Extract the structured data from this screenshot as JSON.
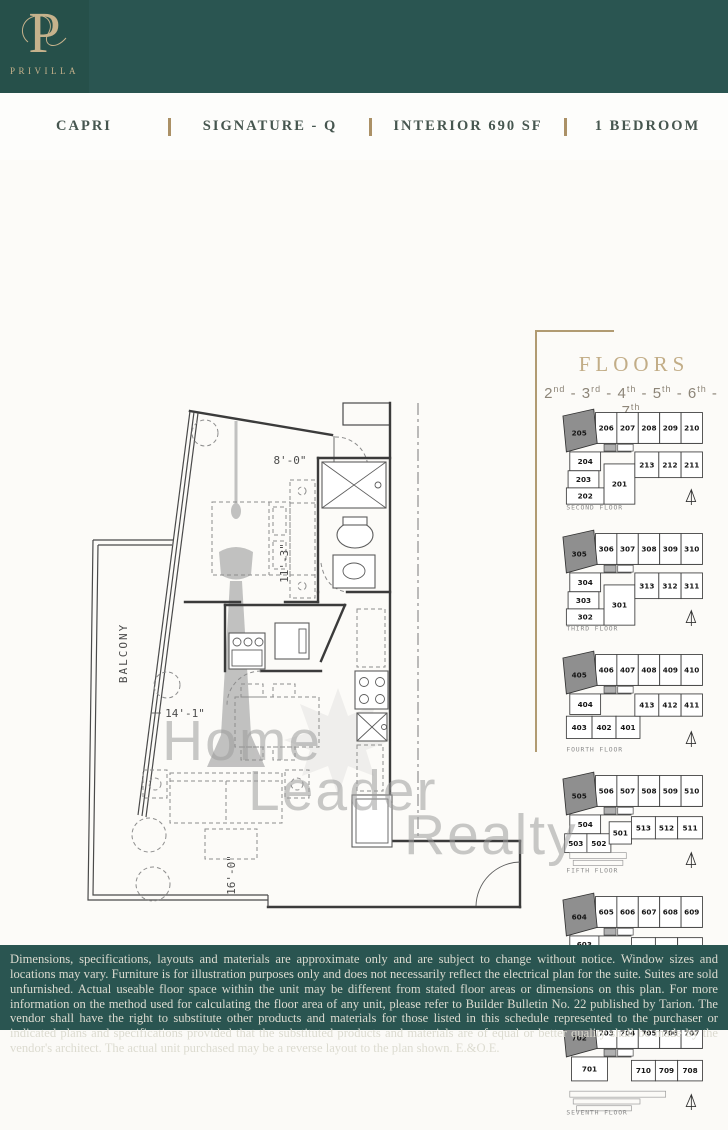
{
  "brand": {
    "monogram": "P",
    "name": "PRIVILLA"
  },
  "title_bar": {
    "items": [
      "CAPRI",
      "SIGNATURE - Q",
      "INTERIOR 690 SF",
      "1 BEDROOM"
    ]
  },
  "plan": {
    "labels": {
      "balcony": "BALCONY"
    },
    "dimensions": {
      "entry": "8'-0\"",
      "bedroom": "11'-3\"",
      "living_width": "14'-1\"",
      "living_depth": "16'-0\""
    },
    "watermark": {
      "line1": "Home",
      "line2": "Leader",
      "line3": "Realty"
    }
  },
  "floors_panel": {
    "title": "FLOORS",
    "range": [
      [
        "2",
        "nd"
      ],
      [
        "3",
        "rd"
      ],
      [
        "4",
        "th"
      ],
      [
        "5",
        "th"
      ],
      [
        "6",
        "th"
      ],
      [
        "7",
        "th"
      ]
    ],
    "range_separator": " - ",
    "floors": [
      {
        "name": "SECOND FLOOR",
        "layout": "A",
        "highlight": "205",
        "top": [
          "206",
          "207",
          "208",
          "209",
          "210"
        ],
        "units": [
          "204",
          "203",
          "202",
          "201",
          "213",
          "212",
          "211"
        ]
      },
      {
        "name": "THIRD FLOOR",
        "layout": "A",
        "highlight": "305",
        "top": [
          "306",
          "307",
          "308",
          "309",
          "310"
        ],
        "units": [
          "304",
          "303",
          "302",
          "301",
          "313",
          "312",
          "311"
        ]
      },
      {
        "name": "FOURTH FLOOR",
        "layout": "B",
        "highlight": "405",
        "top": [
          "406",
          "407",
          "408",
          "409",
          "410"
        ],
        "units": [
          "404",
          "403",
          "402",
          "401",
          "413",
          "412",
          "411"
        ]
      },
      {
        "name": "FIFTH FLOOR",
        "layout": "C",
        "highlight": "505",
        "top": [
          "506",
          "507",
          "508",
          "509",
          "510"
        ],
        "units": [
          "504",
          "503",
          "502",
          "501",
          "513",
          "512",
          "511"
        ]
      },
      {
        "name": "SIXTH FLOOR",
        "layout": "D",
        "highlight": "604",
        "top": [
          "605",
          "606",
          "607",
          "608",
          "609"
        ],
        "units": [
          "603",
          "602",
          "601",
          "612",
          "611",
          "610"
        ]
      },
      {
        "name": "SEVENTH FLOOR",
        "layout": "E",
        "highlight": "702",
        "top": [
          "703",
          "704",
          "705",
          "706",
          "707"
        ],
        "units": [
          "701",
          "710",
          "709",
          "708"
        ]
      }
    ]
  },
  "disclaimer": "Dimensions, specifications, layouts and materials are approximate only and are subject to change without notice. Window sizes and locations may vary. Furniture is for illustration purposes only and does not necessarily reflect the electrical plan for the suite. Suites are sold unfurnished. Actual useable floor space within the unit may be different from stated floor areas or dimensions on this plan. For more information on the method used for calculating the floor area of any unit, please refer to Builder Bulletin No. 22 published by Tarion. The vendor shall have the right to substitute other products and materials for those listed in this schedule represented to the purchaser or indicated plans and specifications provided that the substituted products and materials are of equal or better quality shall be made by the vendor's architect. The actual unit purchased may be a reverse layout to the plan shown. E.&O.E.",
  "colors": {
    "teal": "#2a5551",
    "teal_dark": "#26504a",
    "gold": "#ab9166",
    "tan_heading": "#c2ad87",
    "highlight_unit_fill": "#8f8f8f",
    "watermark_gray": "#9d9d9d"
  }
}
